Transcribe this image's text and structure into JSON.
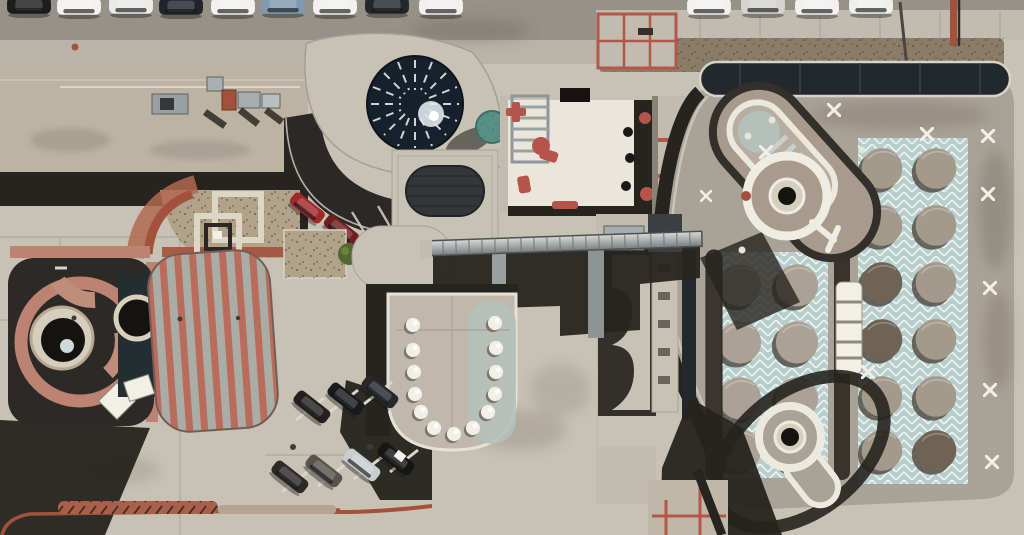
{
  "image_type": "aerial-photograph",
  "description": "Top-down drone photograph of a postmodern civic/mall building complex in bright sunlight, sun from upper right casting hard shadows to lower left. No text is visible anywhere in the image.",
  "palette": {
    "base": "#c8c2b5",
    "road": "#96928a",
    "sidewalk": "#bab4a8",
    "walk2": "#c2bcb0",
    "roof-tan": "#bcb3a2",
    "shadow": "#26241f",
    "black": "#15130f",
    "parapet-white": "#e9e5da",
    "white-paint": "#f2efe7",
    "courtyard-white": "#eae6db",
    "terracotta": "#bd8372",
    "brick-red": "#a4513c",
    "salmon": "#b97e6d",
    "stripe-red": "#b96c5b",
    "stripe-gray": "#a9ada5",
    "teal-tile": "#b7cecc",
    "teal-line": "#eef4f2",
    "verdigris": "#579086",
    "navy-dome": "#16212c",
    "glass-dark": "#23282d",
    "metal-light": "#d9dad6",
    "metal-dark": "#82878a",
    "gravel": "#b3a28a",
    "mulch": "#8b7c68",
    "shrub": "#51682f",
    "red-furniture": "#b5544a",
    "dome": "#aba295",
    "dome-dark": "#776a59",
    "dome-shadow": "#544f47",
    "stadium-tan": "#a89b8c",
    "slab": "#a9a297",
    "keyhole-cream": "#d6cebd",
    "pale-blue": "#b5c0ba",
    "stain": "#6f6859",
    "car-white": "#f2f1ee",
    "car-black": "#1b1d20",
    "car-blue": "#7d9ab1",
    "car-silver": "#d6d4cf",
    "car-darkred": "#8e2a26",
    "car-red": "#b03026"
  },
  "scene": {
    "top_edge": "row of parked cars cut by the frame (white, black, blue, silver) over gray asphalt and a sidewalk band",
    "left_tower": "dark rounded-square tower roof containing a terracotta spiral ramp ring and a cream drum with a dark oculus and small pale dome",
    "striped_canopy": "barrel roof striped lengthwise in salmon red and sage gray with rounded ends",
    "planters": "nested square cream planter walls set in a gravel fan plaza edged by curved brick-red walkways",
    "center_roof": "light concrete roof lobe with a dark radial-spoke glass dome skylight and a verdigris cylindrical vent; dark service drive with two parked red cars",
    "courtyard": "bright white patio with salmon-red tables and chairs and a slatted pergola",
    "sky_bridge": "ribbed metallic covered bridge crossing left-to-right, casting a long shadow",
    "u_pavilion": "U-shaped roof rimmed with 13 white bubble skylights, right half tinted pale blue",
    "parking_south": "angled stalls with seven cars (dark, gray, silver, black)",
    "right_building": "large roof slab with a diagonal stadium form, two white ring / keyhole roof features, grids of circular concrete domes set on pale teal chevron tiles, dark curving spine strips, and scattered white X roof marks",
    "counts": {
      "bubble_skylights": 13,
      "top_row_cars": 13,
      "south_lot_cars": 7,
      "red_service_cars": 2,
      "x_marks": 10,
      "dome_circles": 20
    }
  }
}
